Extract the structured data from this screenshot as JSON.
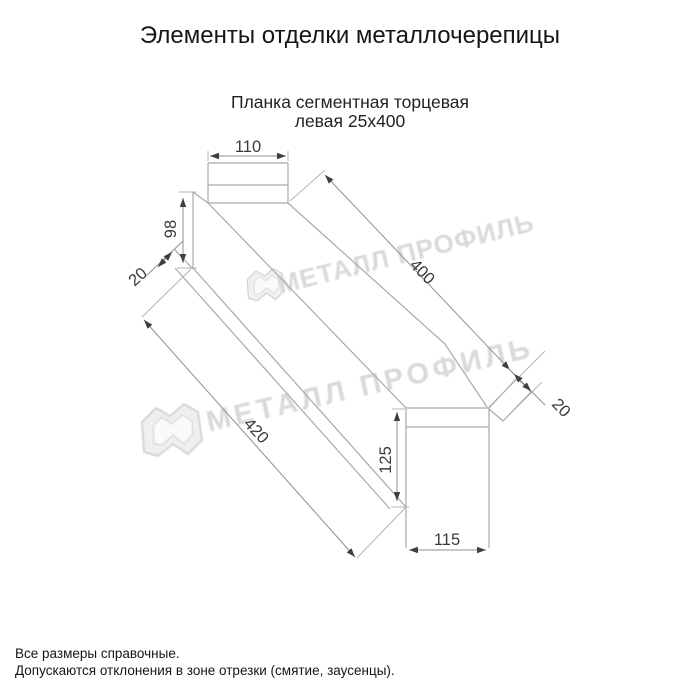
{
  "page": {
    "title": "Элементы отделки металлочерепицы",
    "subtitle_line1": "Планка сегментная торцевая",
    "subtitle_line2": "левая 25х400"
  },
  "drawing": {
    "product": "Планка сегментная торцевая левая 25х400",
    "dims": {
      "head_width": "110",
      "left_height": "98",
      "left_fold": "20",
      "top_length": "400",
      "bottom_length": "420",
      "end_fold": "20",
      "end_height": "125",
      "end_width": "115"
    },
    "colors": {
      "part_line": "#a9a9a9",
      "dimension_line": "#8f8f8f",
      "dimension_text": "#3a3a3a",
      "arrow": "#3f3f3f"
    }
  },
  "watermark": {
    "text": "МЕТАЛЛ ПРОФИЛЬ",
    "color": "#d8d8d8"
  },
  "footer": {
    "note1": "Все размеры справочные.",
    "note2": "Допускаются отклонения в зоне отрезки (смятие, заусенцы)."
  }
}
